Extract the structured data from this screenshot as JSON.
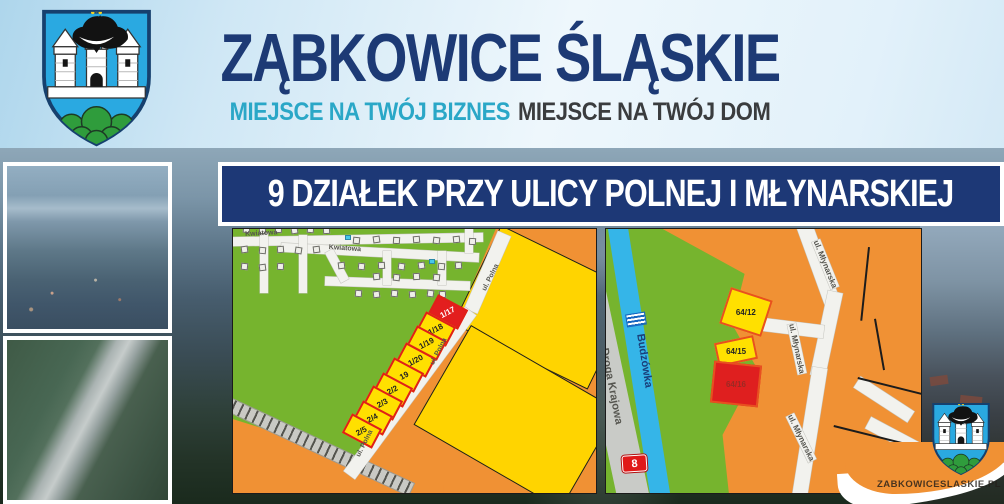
{
  "header": {
    "title": "ZĄBKOWICE ŚLĄSKIE",
    "subtitle_business": "MIEJSCE NA TWÓJ BIZNES",
    "subtitle_home": "MIEJSCE NA TWÓJ DOM"
  },
  "banner": {
    "text": "9 DZIAŁEK PRZY ULICY POLNEJ I MŁYNARSKIEJ"
  },
  "watermark": {
    "text": "ZABKOWICESLASKIE.PL"
  },
  "icons": {
    "crest": "zabkowice-slaskie-coat-of-arms",
    "waves": "river-waves-icon",
    "route_badge": "national-road-number-badge"
  },
  "left_map": {
    "street_labels": [
      {
        "text": "Kwiatowa",
        "x": 12,
        "y": 2,
        "rot": -3
      },
      {
        "text": "Kwiatowa",
        "x": 96,
        "y": 15,
        "rot": 4
      },
      {
        "text": "ul. Polna",
        "x": 248,
        "y": 60,
        "rot": -63
      },
      {
        "text": "ul. Polna",
        "x": 196,
        "y": 134,
        "rot": -63
      },
      {
        "text": "ul. Polna",
        "x": 122,
        "y": 226,
        "rot": -63
      }
    ],
    "plots": [
      {
        "label": "1/17",
        "x": 198,
        "y": 72,
        "sold": true
      },
      {
        "label": "1/18",
        "x": 186,
        "y": 89
      },
      {
        "label": "1/19",
        "x": 177,
        "y": 103
      },
      {
        "label": "1/20",
        "x": 166,
        "y": 120
      },
      {
        "label": "19",
        "x": 154,
        "y": 135
      },
      {
        "label": "2/2",
        "x": 143,
        "y": 150
      },
      {
        "label": "2/3",
        "x": 133,
        "y": 163
      },
      {
        "label": "2/4",
        "x": 123,
        "y": 178
      },
      {
        "label": "2/5",
        "x": 112,
        "y": 191
      }
    ],
    "houses": [
      [
        10,
        -3,
        8
      ],
      [
        26,
        -2,
        -6
      ],
      [
        42,
        -3,
        4
      ],
      [
        58,
        -2,
        -10
      ],
      [
        74,
        -3,
        6
      ],
      [
        90,
        -2,
        -4
      ],
      [
        8,
        17,
        -8
      ],
      [
        26,
        18,
        5
      ],
      [
        44,
        17,
        -5
      ],
      [
        62,
        18,
        9
      ],
      [
        80,
        17,
        -7
      ],
      [
        120,
        8,
        6
      ],
      [
        140,
        7,
        -8
      ],
      [
        160,
        8,
        4
      ],
      [
        180,
        7,
        -5
      ],
      [
        200,
        8,
        7
      ],
      [
        220,
        7,
        -6
      ],
      [
        236,
        9,
        3
      ],
      [
        105,
        33,
        -7
      ],
      [
        125,
        34,
        6
      ],
      [
        145,
        33,
        -4
      ],
      [
        165,
        34,
        8
      ],
      [
        185,
        33,
        -9
      ],
      [
        205,
        34,
        5
      ],
      [
        222,
        33,
        -5
      ],
      [
        8,
        34,
        6
      ],
      [
        26,
        35,
        -7
      ],
      [
        44,
        34,
        4
      ],
      [
        140,
        44,
        -6
      ],
      [
        160,
        45,
        7
      ],
      [
        180,
        44,
        -4
      ],
      [
        200,
        45,
        6
      ],
      [
        122,
        61,
        5
      ],
      [
        140,
        62,
        -7
      ],
      [
        158,
        61,
        6
      ],
      [
        176,
        62,
        -5
      ],
      [
        194,
        61,
        8
      ],
      [
        206,
        62,
        -4
      ]
    ],
    "pools": [
      [
        112,
        6
      ],
      [
        196,
        30
      ]
    ]
  },
  "right_map": {
    "river_label": {
      "text": "Budzówka",
      "x": 40,
      "y": 104,
      "rot": 81
    },
    "road_label": {
      "text": "Droga Krajowa",
      "x": 4,
      "y": 118,
      "rot": 79
    },
    "route_badge": "8",
    "street_labels": [
      {
        "text": "ul. Młynarska",
        "x": 214,
        "y": 10,
        "rot": 68
      },
      {
        "text": "ul. Młynarska",
        "x": 190,
        "y": 94,
        "rot": 78
      },
      {
        "text": "ul. Młynarska",
        "x": 188,
        "y": 184,
        "rot": 64
      }
    ],
    "plots": [
      {
        "label": "64/12",
        "x": 118,
        "y": 64,
        "w": 44,
        "h": 38,
        "rot": 18,
        "type": "available"
      },
      {
        "label": "64/15",
        "x": 110,
        "y": 110,
        "w": 40,
        "h": 24,
        "rot": -12,
        "type": "available"
      },
      {
        "label": "64/16",
        "x": 106,
        "y": 134,
        "w": 48,
        "h": 42,
        "rot": 6,
        "type": "sold"
      }
    ]
  },
  "colors": {
    "navy": "#1d3a75",
    "teal": "#2aa7c7",
    "dark_text": "#3a3c3e",
    "map_green": "#76b42e",
    "map_orange": "#f09134",
    "plot_yellow": "#ffe000",
    "plot_red": "#e31e1e",
    "river_blue": "#35b5e8",
    "road_gray": "#c9cbc7",
    "banner_navy": "#1d3876"
  }
}
